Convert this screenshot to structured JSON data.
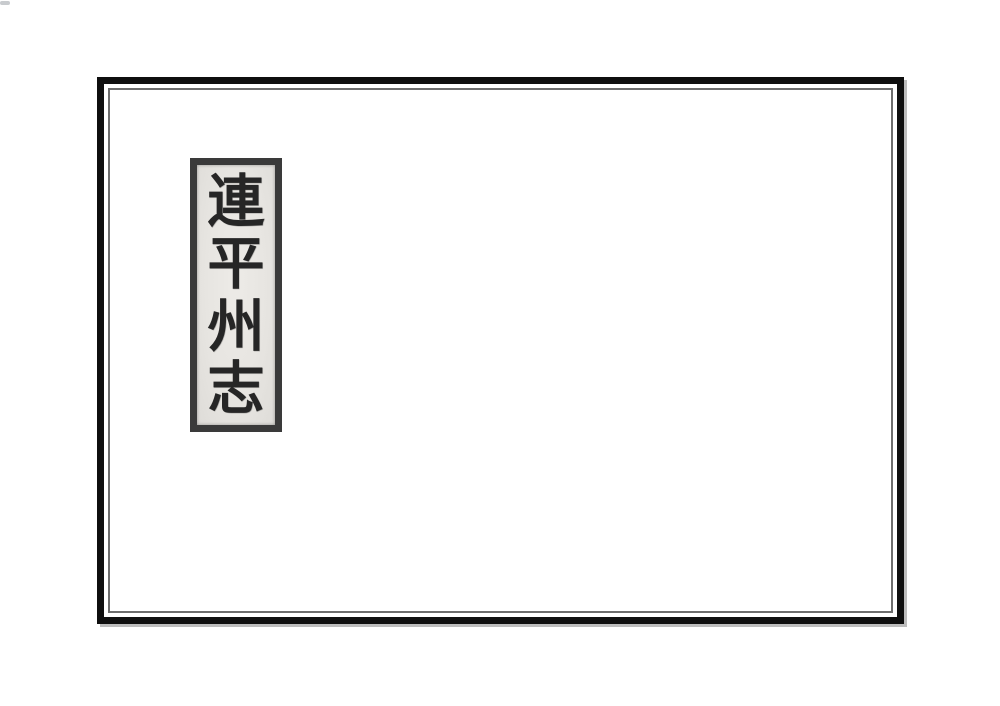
{
  "document": {
    "kind": "scanned-book-cover",
    "background_color": "#ffffff"
  },
  "frame": {
    "outer_border_color": "#0f0f0f",
    "inner_border_color": "#6d6d6d",
    "shadow_color": "#bdbdbd"
  },
  "title_label": {
    "full_text": "連平州志",
    "characters": [
      "連",
      "平",
      "州",
      "志"
    ],
    "paper_color": "#e7e5e1",
    "border_color": "#3a3a3a",
    "ink_color": "#262626"
  }
}
